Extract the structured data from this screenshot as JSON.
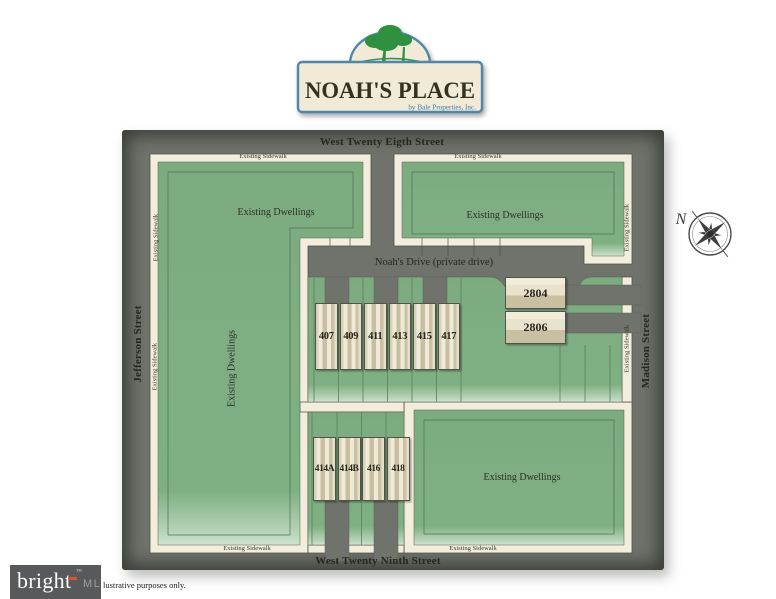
{
  "logo": {
    "title": "NOAH'S PLACE",
    "subtitle": "by Bale Properties, Inc."
  },
  "map": {
    "streets": {
      "north": "West Twenty Eigth Street",
      "south": "West Twenty Ninth Street",
      "west": "Jefferson Street",
      "east": "Madison Street",
      "private_drive": "Noah's Drive (private drive)"
    },
    "area_labels": {
      "existing_dwellings": "Existing Dwellings",
      "existing_sidewalk": "Existing Sidewalk"
    },
    "lots": {
      "north_row": [
        "407",
        "409",
        "411",
        "413",
        "415",
        "417"
      ],
      "south_row": [
        "414A",
        "414B",
        "416",
        "418"
      ],
      "east_units": [
        "2804",
        "2806"
      ]
    },
    "compass_north": "N"
  },
  "footer": {
    "brand": "bright",
    "brand_suffix": "MLS",
    "trademark": "™",
    "disclaimer": "lustrative purposes only."
  },
  "colors": {
    "lawn_green": "#7fb083",
    "sidewalk_cream": "#f3eedb",
    "street_gray": "#6f736b",
    "sign_border_blue": "#4e87ab",
    "tree_green": "#2f9040",
    "building_tan": "#c8bea1",
    "brand_bar_gray": "#58595b",
    "brand_accent_orange": "#d4553a"
  }
}
